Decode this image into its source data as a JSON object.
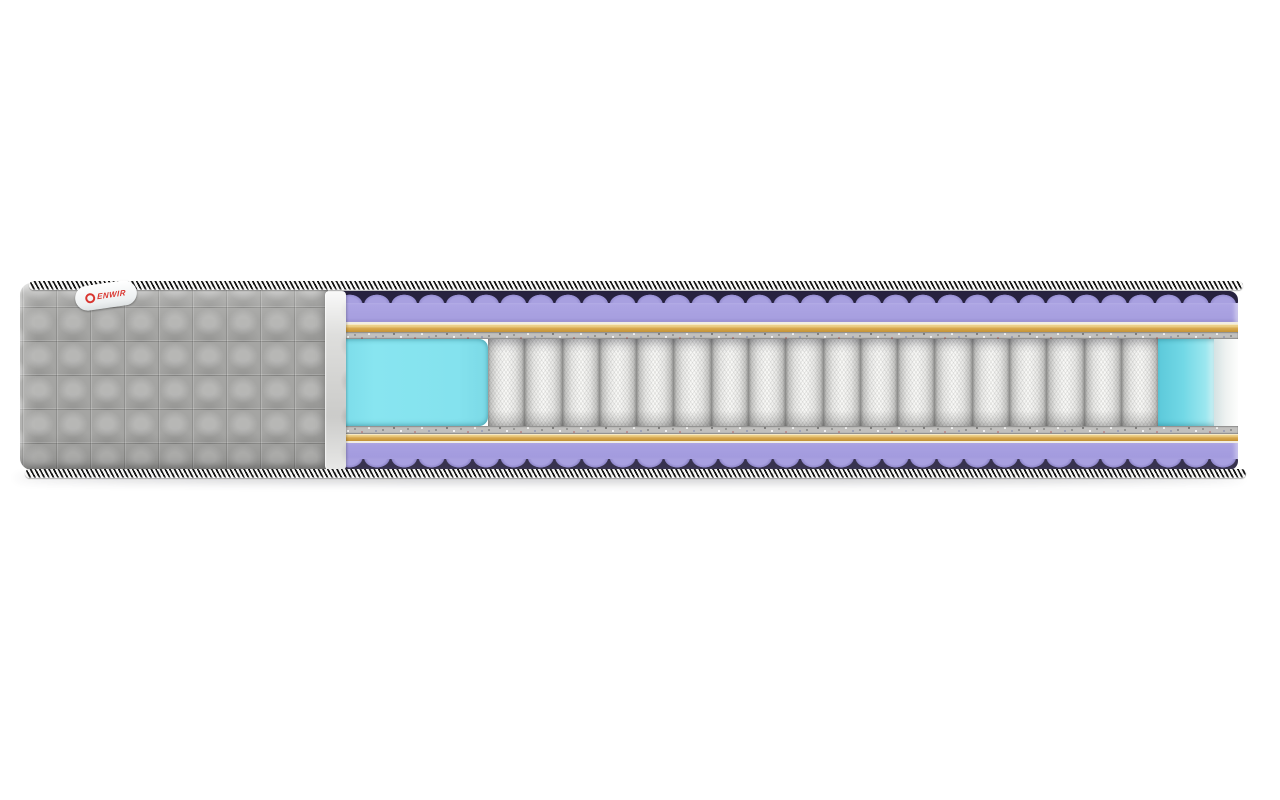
{
  "scene": {
    "description": "Side cutaway product render of a pocket-spring mattress on a white background",
    "background_color": "#ffffff"
  },
  "brand_tag": {
    "text": "ENWIR",
    "logo": "red-ring-logo",
    "text_color": "#d9352f"
  },
  "mattress": {
    "cover": {
      "style": "quilted squares",
      "quilt_columns": 9,
      "quilt_rows": 5,
      "color": "#a5a5a3",
      "cut_edge_color": "#d8d8d6"
    },
    "piping": {
      "stripe_dark": "#141414",
      "stripe_light": "#f6f6f5"
    },
    "layers_top_to_bottom": [
      {
        "name": "wavy-purple-foam-top",
        "color": "#a8a0e0"
      },
      {
        "name": "cream-liner-top",
        "color": "#f1ede2"
      },
      {
        "name": "orange-layer-top",
        "color": "#d8a84e"
      },
      {
        "name": "gray-felt-pad-top",
        "color": "#c1c0be"
      },
      {
        "name": "pocket-spring-core-with-side-foam",
        "color": "#f8f8f6"
      },
      {
        "name": "gray-felt-pad-bottom",
        "color": "#c1c0be"
      },
      {
        "name": "orange-layer-bottom",
        "color": "#d8a84e"
      },
      {
        "name": "cream-liner-bottom",
        "color": "#f1ede2"
      },
      {
        "name": "wavy-purple-foam-bottom",
        "color": "#a8a0e0"
      }
    ],
    "springs": {
      "count": 18,
      "fabric_color": "#f8f8f6",
      "seam_color": "#8f8f8d"
    },
    "side_foam": {
      "color": "#84e2ee",
      "positions": [
        "left-of-springs",
        "right-of-springs"
      ]
    }
  },
  "colors": {
    "bg": "#ffffff",
    "quilt_gray": "#a5a5a3",
    "piping_dark": "#141414",
    "piping_light": "#f6f6f5",
    "foam_purple": "#a8a0e0",
    "wave_dark": "#27223f",
    "orange": "#d8a84e",
    "liner_cream": "#f1ede2",
    "felt_gray": "#c1c0be",
    "cyan": "#84e2ee",
    "spring_white": "#f8f8f6",
    "spring_seam": "#8f8f8d",
    "tag_red": "#d9352f"
  }
}
